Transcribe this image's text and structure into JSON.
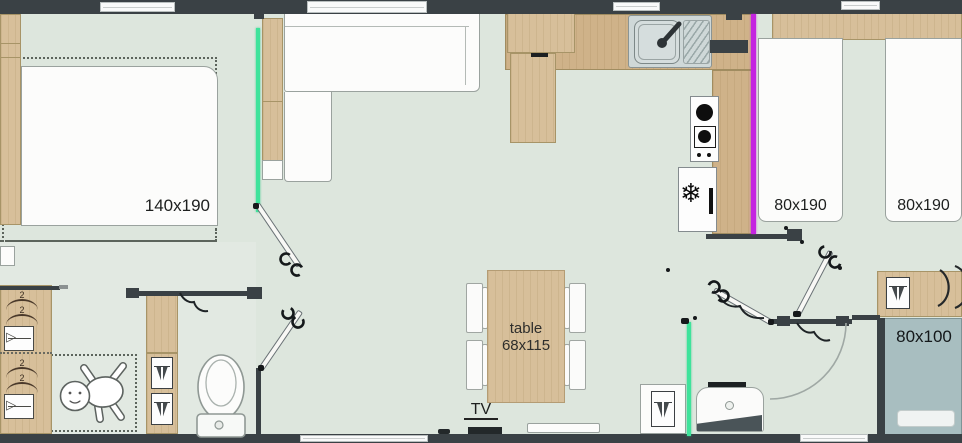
{
  "plan": {
    "title": "mobile-home floor plan",
    "labels": {
      "master_bed": "140x190",
      "bed_right_1": "80x190",
      "bed_right_2": "80x190",
      "shower": "80x100",
      "table_name": "table",
      "table_size": "68x115",
      "tv": "TV",
      "hanger_qty": "2"
    },
    "colors": {
      "floor": "#dde6dd",
      "wall": "#3a4145",
      "wood": "#d7bf9a",
      "wood_dark": "#cfb289",
      "accent_green": "#3fe39b",
      "accent_magenta": "#c424e0",
      "shower_fill": "#a8bec0"
    }
  }
}
